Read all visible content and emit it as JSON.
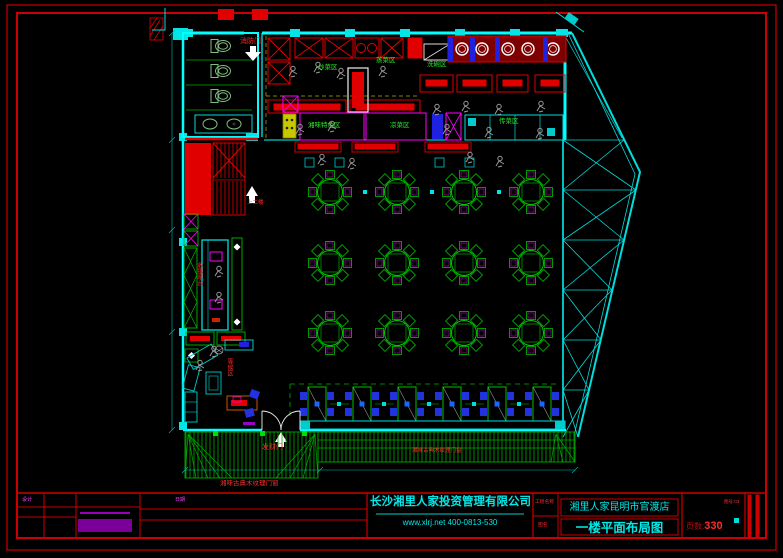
{
  "title_block": {
    "company": "长沙湘里人家投资管理有限公司",
    "contact": "www.xlrj.net 400-0813-530",
    "field_project": "工程名称",
    "field_drawing": "图名",
    "project_name": "湘里人家昆明市官渡店",
    "drawing_name": "一楼平面布局图",
    "page_label": "页数:",
    "page_value": "330",
    "corner_note": "图号:03",
    "sign_left": "设计",
    "sign_right": "日期"
  },
  "plan_labels": {
    "fire_door": "消防门",
    "stairs_up": "上二楼",
    "cashier_bar": "收银吧台",
    "waiting_area": "等候区",
    "fortune_door": "发财门",
    "wok_zone": "炒菜区",
    "steam_zone": "蒸菜区",
    "dishwash_zone": "洗碗区",
    "pass_zone": "传菜区",
    "special_zone": "湘味特色区",
    "cold_zone": "凉菜区",
    "storefront_note_inner": "湘味古典木纹理门窗",
    "storefront_note_outer": "湘味古典木纹理门窗"
  },
  "colors": {
    "wall": "#00ffff",
    "equipment": "#ee0000",
    "furniture": "#00bb00",
    "fixture": "#ff00ff",
    "seat": "#2222ee",
    "frame": "#cc0000"
  }
}
